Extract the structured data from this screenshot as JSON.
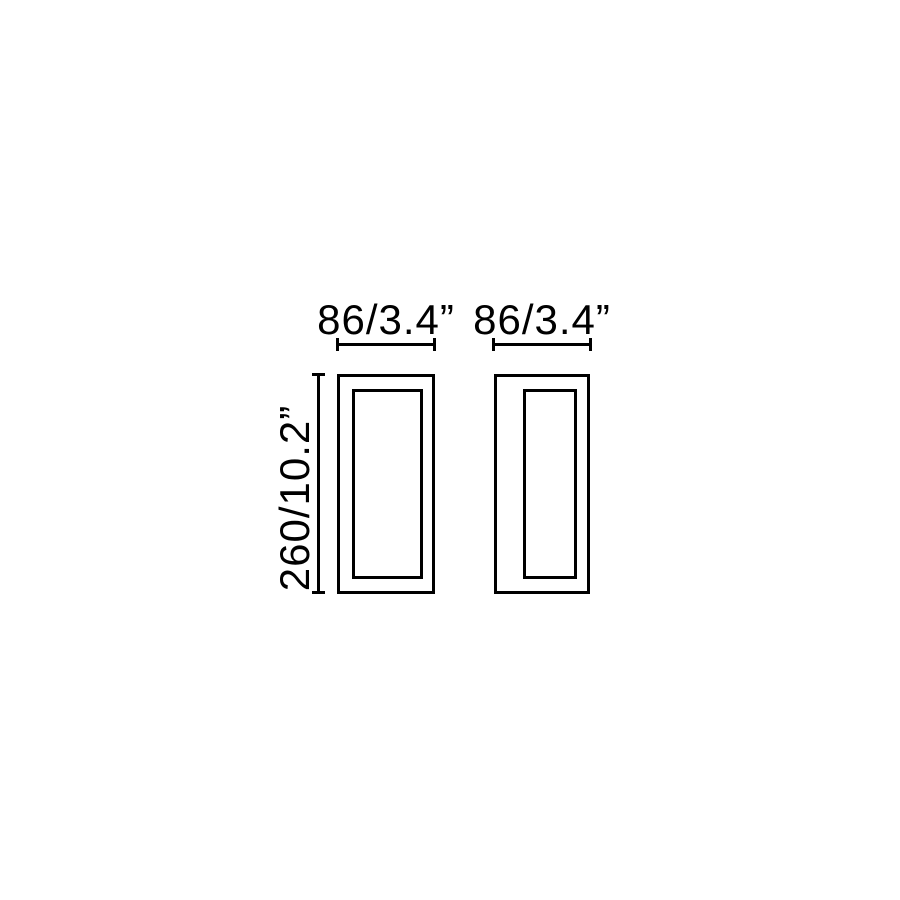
{
  "diagram": {
    "description": "Technical dimension drawing with two rectangular views of a wall light fixture",
    "background_color": "#ffffff",
    "line_color": "#000000",
    "views": [
      {
        "name": "front-view",
        "width_label": "86/3.4”",
        "height_label": "260/10.2”"
      },
      {
        "name": "side-view",
        "width_label": "86/3.4”"
      }
    ],
    "dimensions": {
      "width_mm": 86,
      "width_in": 3.4,
      "height_mm": 260,
      "height_in": 10.2
    }
  }
}
